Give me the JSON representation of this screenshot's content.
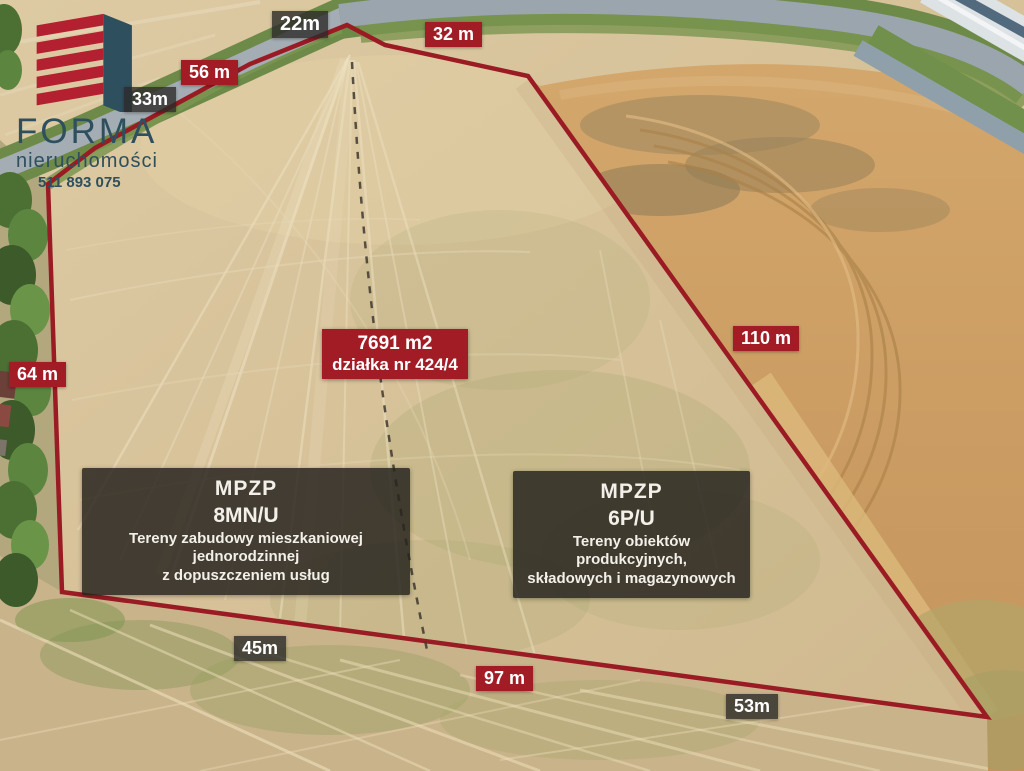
{
  "branding": {
    "name": "FORMA",
    "tagline": "nieruchomości",
    "phone": "511 893 075"
  },
  "parcel_info": {
    "area": "7691 m2",
    "plot_number": "działka nr 424/4"
  },
  "lengths": {
    "top": "22m",
    "top_right": "32 m",
    "upper_left_outer": "56 m",
    "upper_left_inner": "33m",
    "left": "64 m",
    "right": "110 m",
    "bottom_left": "45m",
    "bottom_center": "97 m",
    "bottom_right": "53m"
  },
  "zoning": {
    "residential": {
      "heading": "MPZP",
      "code": "8MN/U",
      "desc_line1": "Tereny zabudowy mieszkaniowej jednorodzinnej",
      "desc_line2": "z dopuszczeniem usług"
    },
    "industrial": {
      "heading": "MPZP",
      "code": "6P/U",
      "desc_line1": "Tereny obiektów produkcyjnych,",
      "desc_line2": "składowych i magazynowych"
    }
  },
  "colors": {
    "boundary_line": "#9a1b23",
    "divider_line": "#3e382f",
    "red_label_bg": "#a21c26",
    "dark_label_bg": "rgba(44,42,40,0.8)",
    "zone_box_bg": "rgba(38,34,30,0.84)",
    "logo_red": "#b32030",
    "logo_slate": "#2d4f5e"
  }
}
